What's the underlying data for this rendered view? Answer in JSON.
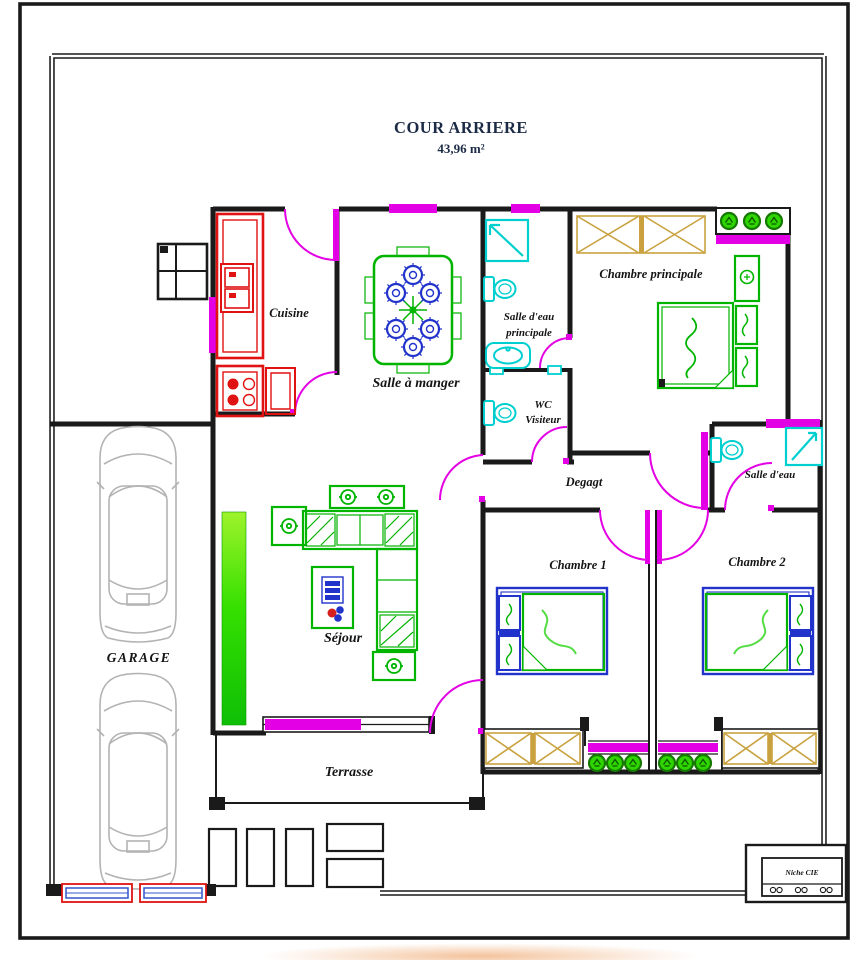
{
  "title": {
    "name": "COUR ARRIERE",
    "area": "43,96 m²"
  },
  "rooms": {
    "cuisine": {
      "label": "Cuisine"
    },
    "salle_a_manger": {
      "label": "Salle à manger"
    },
    "salle_eau_principale": {
      "line1": "Salle d'eau",
      "line2": "principale"
    },
    "chambre_principale": {
      "label": "Chambre principale"
    },
    "wc_visiteur": {
      "line1": "WC",
      "line2": "Visiteur"
    },
    "degagt": {
      "label": "Degagt"
    },
    "salle_eau": {
      "label": "Salle d'eau"
    },
    "chambre_1": {
      "label": "Chambre 1"
    },
    "chambre_2": {
      "label": "Chambre 2"
    },
    "sejour": {
      "label": "Séjour"
    },
    "terrasse": {
      "label": "Terrasse"
    },
    "garage": {
      "label": "GARAGE"
    },
    "niche_cie": {
      "label": "Niche CIE"
    }
  },
  "colors": {
    "wall": "#1a1a1a",
    "door_window": "#e400e4",
    "kitchen_red": "#e01212",
    "furniture_green": "#00b400",
    "plumbing_cyan": "#00cfcf",
    "chair_blue": "#2233cc",
    "wardrobe_tan": "#c9a23f",
    "car_gray": "#b3b3b3",
    "hedge_green_top": "#9ef32b",
    "hedge_green_bottom": "#0fbf06",
    "title_text": "#1c2b45",
    "label_text": "#141414"
  }
}
